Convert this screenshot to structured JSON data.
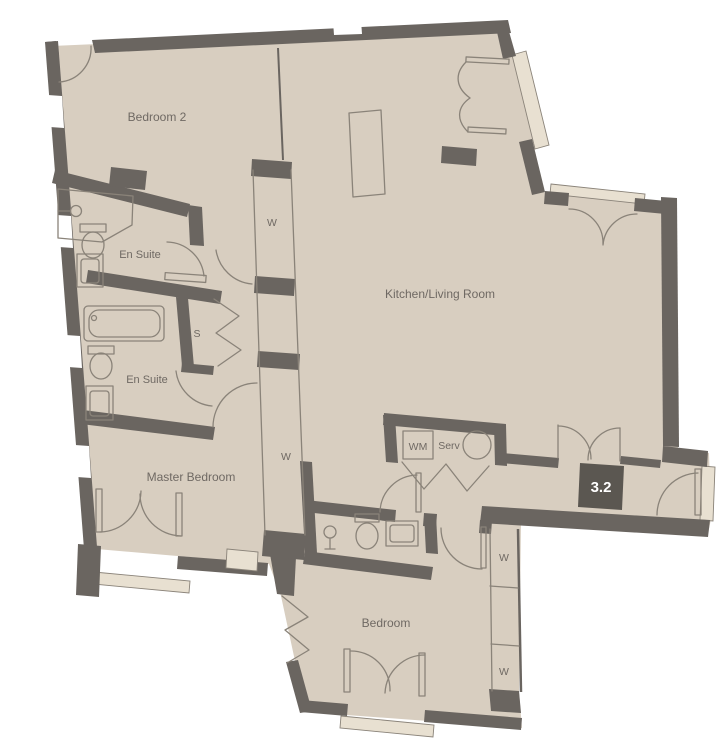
{
  "floorplan": {
    "unit": {
      "number": "3.2"
    },
    "rooms": {
      "bedroom2": "Bedroom 2",
      "ensuite_top": "En Suite",
      "ensuite_bottom": "En Suite",
      "master_bedroom": "Master Bedroom",
      "kitchen_living": "Kitchen/Living Room",
      "bedroom": "Bedroom"
    },
    "features": {
      "wardrobe_top": "W",
      "wardrobe_master": "W",
      "wardrobe_bedroom_upper": "W",
      "wardrobe_bedroom_lower": "W",
      "store": "S",
      "washing_machine": "WM",
      "service": "Serv"
    },
    "colors": {
      "floor": "#d8cec0",
      "wall": "#6a6560",
      "line": "#8a8379",
      "text": "#6f6963",
      "unit_bg": "#5b5751",
      "unit_text": "#ffffff",
      "threshold": "#e8e0d1",
      "background": "#ffffff"
    }
  }
}
